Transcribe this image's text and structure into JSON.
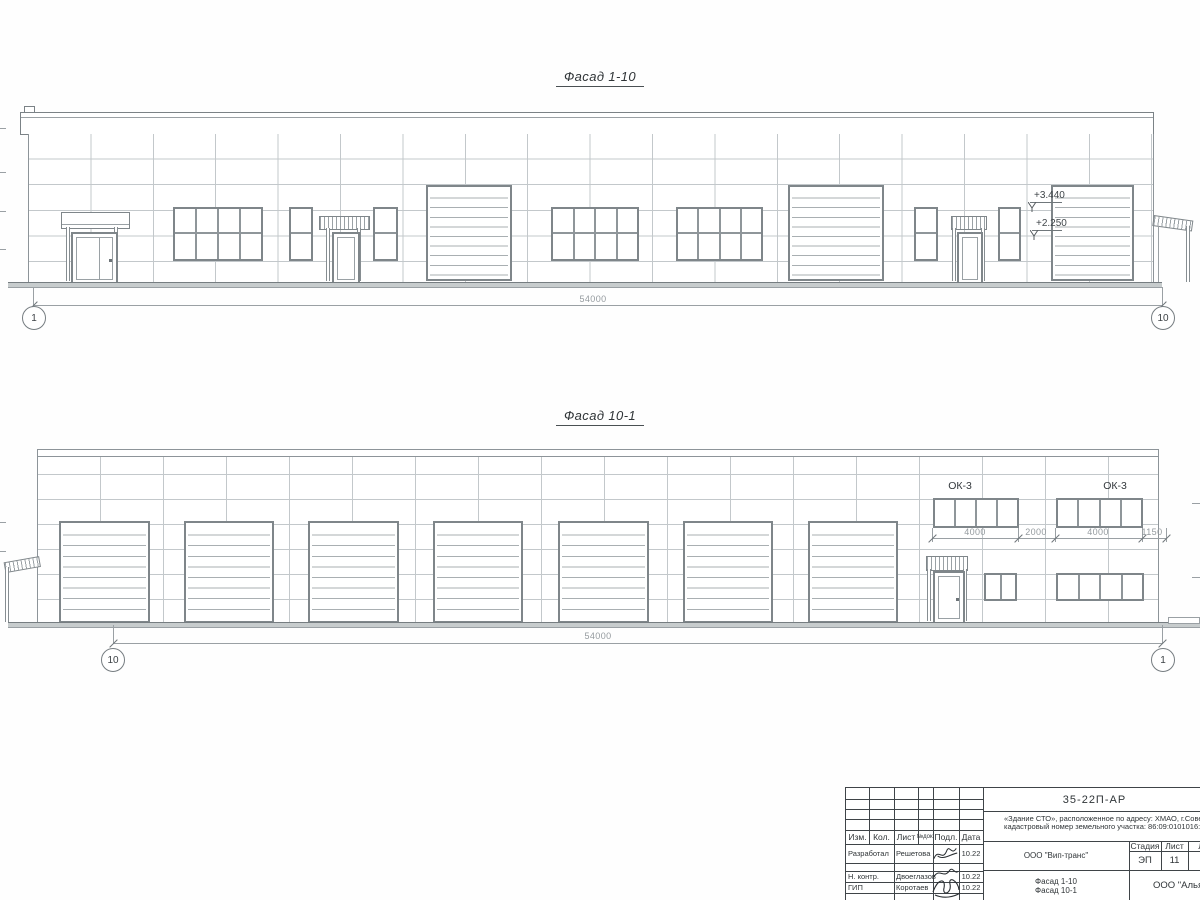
{
  "palette": {
    "drawing_line": "#8d9499",
    "panel_joint": "#c3c8cb",
    "dim_text": "#949a9e",
    "dark_text": "#2f3437"
  },
  "facade_top": {
    "title": "Фасад 1-10",
    "total_dim": "54000",
    "axis_left": "1",
    "axis_right": "10",
    "elev_upper": "+3.440",
    "elev_lower": "+2.250"
  },
  "facade_bottom": {
    "title": "Фасад 10-1",
    "total_dim": "54000",
    "axis_left": "10",
    "axis_right": "1",
    "ok3_left": "ОК-3",
    "ok3_right": "ОК-3",
    "dims": [
      "4000",
      "2000",
      "4000",
      "1150"
    ]
  },
  "title_block": {
    "doc_number": "35-22П-АР",
    "object_line1": "«Здание СТО», расположенное по адресу: ХМАО, г.Советск",
    "object_line2": "кадастровый номер земельного участка: 86:09:0101016:15",
    "col_izm": "Изм.",
    "col_kol": "Кол.",
    "col_list": "Лист",
    "col_ndok": "№док.",
    "col_podp": "Подл.",
    "col_data": "Дата",
    "row1_role": "Разработал",
    "row1_name": "Решетова",
    "row1_date": "10.22",
    "row2_role": "Н. контр.",
    "row2_name": "Двоеглазов",
    "row2_date": "10.22",
    "row3_role": "ГИП",
    "row3_name": "Коротаев",
    "row3_date": "10.22",
    "client": "ООО \"Вип-транс\"",
    "stage_label": "Стадия",
    "sheet_label": "Лист",
    "sheets_label": "Л",
    "stage_value": "ЭП",
    "sheet_value": "11",
    "content_line1": "Фасад 1-10",
    "content_line2": "Фасад 10-1",
    "company": "ООО \"Альян"
  }
}
